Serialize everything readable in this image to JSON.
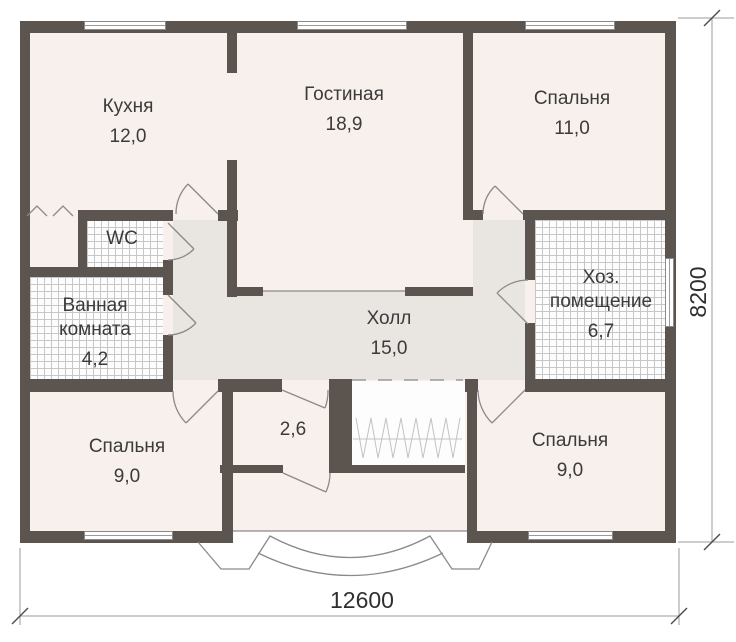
{
  "plan_type": "floor-plan",
  "rooms": {
    "kitchen": {
      "name": "Кухня",
      "area": "12,0"
    },
    "living": {
      "name": "Гостиная",
      "area": "18,9"
    },
    "bedroom_top_right": {
      "name": "Спальня",
      "area": "11,0"
    },
    "wc": {
      "name": "WC"
    },
    "bathroom": {
      "name": "Ванная комната",
      "area": "4,2"
    },
    "utility": {
      "name": "Хоз. помещение",
      "area": "6,7"
    },
    "hall": {
      "name": "Холл",
      "area": "15,0"
    },
    "bedroom_bottom_left": {
      "name": "Спальня",
      "area": "9,0"
    },
    "entry": {
      "area": "2,6"
    },
    "bedroom_bottom_right": {
      "name": "Спальня",
      "area": "9,0"
    }
  },
  "dimensions": {
    "width_label": "12600",
    "height_label": "8200"
  },
  "colors": {
    "wall": "#5b544f",
    "room_fill": "#f8f0ec",
    "hall_fill": "#e9e5e1",
    "tile_line": "#c7c7c7",
    "thin_line": "#8a8a8a",
    "text": "#3b3b3b"
  }
}
